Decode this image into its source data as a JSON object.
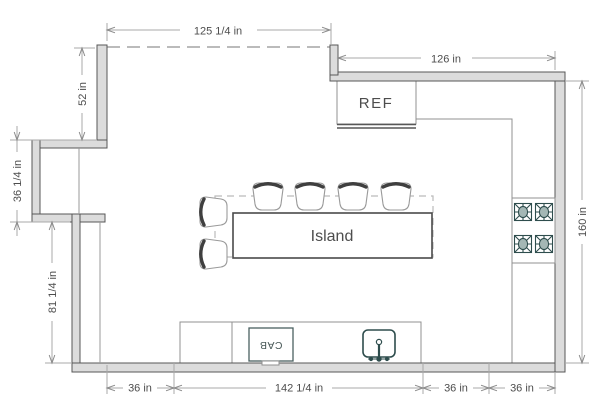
{
  "drawing_type": "kitchen-floor-plan",
  "dimensions": {
    "top": "125 1/4 in",
    "top_right": "126 in",
    "left_upper": "52 in",
    "left_mid": "36 1/4 in",
    "left_lower": "81 1/4 in",
    "right": "160 in",
    "bottom": [
      "36 in",
      "142 1/4 in",
      "36 in",
      "36 in"
    ]
  },
  "labels": {
    "refrigerator": "REF",
    "island": "Island",
    "cabinet": "CAB"
  },
  "fixtures": {
    "bar_stools": 6,
    "cooktop_burners": 4,
    "sinks": 1
  },
  "colors": {
    "wall_fill": "#dcdcdc",
    "wall_stroke": "#575757",
    "counter_stroke": "#909090",
    "island_stroke": "#4a4a4a",
    "fixture_outline": "#2e4d4d",
    "burner_fill": "#a4b7b5",
    "dashed_line": "#bbbbbb",
    "dim_line": "#a8a8a8",
    "arrow": "#8a8a8a",
    "dim_text": "#4d4d4d",
    "stool_back": "#3f3f3f",
    "stool_seat_stroke": "#9a9a9a"
  }
}
